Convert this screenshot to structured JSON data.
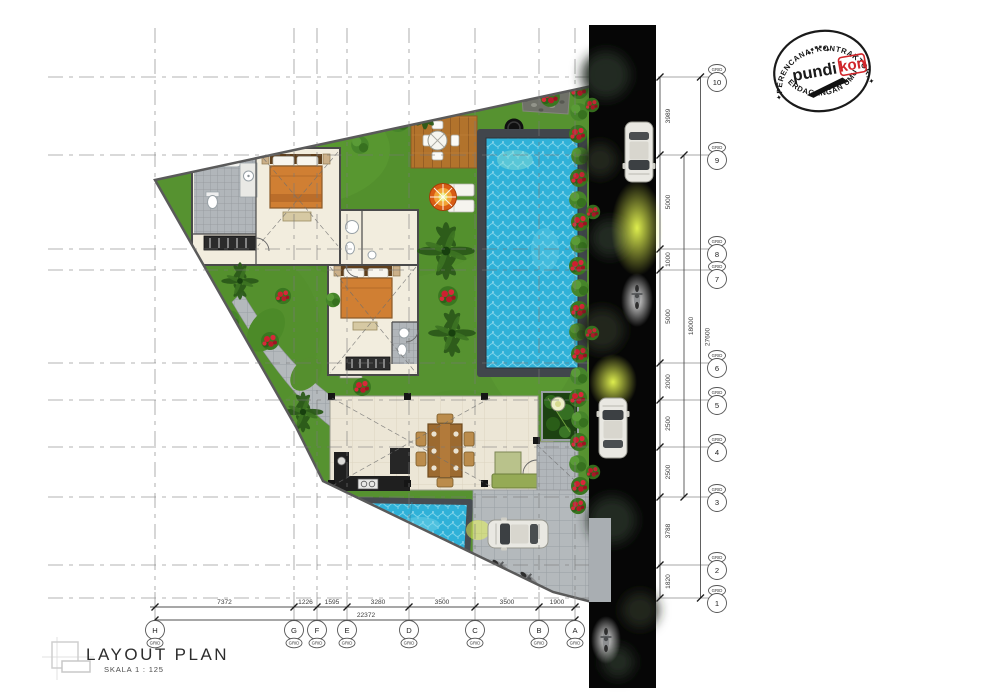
{
  "title": {
    "text": "LAYOUT PLAN",
    "scale": "SKALA 1 : 125"
  },
  "stamp": {
    "arc_top": "PERENCANA, KONTRAKTOR.",
    "arc_bottom": "PERDAGANGAN UMUM",
    "brand_left": "pundi",
    "brand_right": "kon",
    "star": "✦"
  },
  "grid_rows": [
    {
      "tag": "GRID",
      "num": "10"
    },
    {
      "tag": "GRID",
      "num": "9"
    },
    {
      "tag": "GRID",
      "num": "8"
    },
    {
      "tag": "GRID",
      "num": "7"
    },
    {
      "tag": "GRID",
      "num": "6"
    },
    {
      "tag": "GRID",
      "num": "5"
    },
    {
      "tag": "GRID",
      "num": "4"
    },
    {
      "tag": "GRID",
      "num": "3"
    },
    {
      "tag": "GRID",
      "num": "2"
    },
    {
      "tag": "GRID",
      "num": "1"
    }
  ],
  "grid_cols": [
    {
      "tag": "GRID",
      "letter": "H"
    },
    {
      "tag": "GRID",
      "letter": "G"
    },
    {
      "tag": "GRID",
      "letter": "F"
    },
    {
      "tag": "GRID",
      "letter": "E"
    },
    {
      "tag": "GRID",
      "letter": "D"
    },
    {
      "tag": "GRID",
      "letter": "C"
    },
    {
      "tag": "GRID",
      "letter": "B"
    },
    {
      "tag": "GRID",
      "letter": "A"
    }
  ],
  "dims_right": [
    "3989",
    "5000",
    "1000",
    "5000",
    "2000",
    "2500",
    "2500",
    "3788",
    "1820"
  ],
  "right_subtotal": "18000",
  "right_total": "27600",
  "dims_bottom": [
    "7372",
    "1226",
    "1595",
    "3280",
    "3500",
    "3500",
    "1900"
  ],
  "bottom_total": "22372",
  "colors": {
    "grass": "#569230",
    "pool_water": "#2fb1d8",
    "road": "#060606",
    "stamp_red": "#d0252a",
    "bed_orange": "#d07f33"
  }
}
